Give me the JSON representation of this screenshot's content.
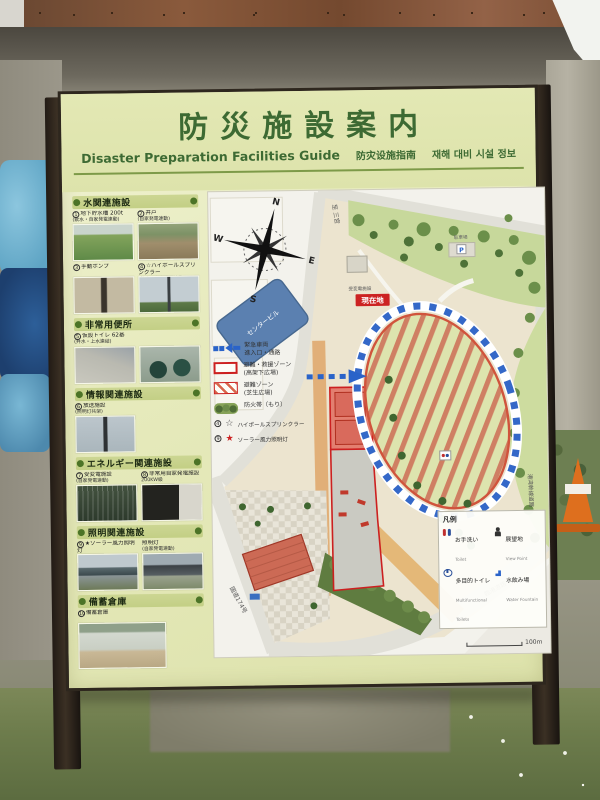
{
  "sign": {
    "title": "防災施設案内",
    "subtitles": {
      "en": "Disaster Preparation Facilities Guide",
      "zh": "防灾设施指南",
      "ko": "재해 대비 시설 정보"
    },
    "sidebar": {
      "sections": [
        {
          "title": "水関連施設",
          "items": [
            {
              "num": "1",
              "label": "地下貯水槽 200t",
              "sub": "(飲水・自家発電連動)"
            },
            {
              "num": "2",
              "label": "井戸",
              "sub": "(自家発電連動)"
            },
            {
              "num": "3",
              "label": "手動ポンプ",
              "sub": ""
            },
            {
              "num": "4",
              "label": "☆ハイポールスプリンクラー",
              "sub": "(飲水・自家発電連動)"
            }
          ]
        },
        {
          "title": "非常用便所",
          "items": [
            {
              "num": "5",
              "label": "仮設トイレ 62基",
              "sub": "(井水・上水連結)"
            }
          ]
        },
        {
          "title": "情報関連施設",
          "items": [
            {
              "num": "6",
              "label": "放送施設",
              "sub": "(照明灯共架)"
            }
          ]
        },
        {
          "title": "エネルギー関連施設",
          "items": [
            {
              "num": "7",
              "label": "受変電施設",
              "sub": "(自家発電連動)"
            },
            {
              "num": "8",
              "label": "非常用自家発電施設",
              "sub": "200KW級"
            }
          ]
        },
        {
          "title": "照明関連施設",
          "items": [
            {
              "num": "9",
              "label": "★ソーラー風力照明灯",
              "sub": ""
            },
            {
              "num": "",
              "label": "照明灯",
              "sub": "(自家発電連動)"
            }
          ]
        },
        {
          "title": "備蓄倉庫",
          "items": [
            {
              "num": "10",
              "label": "備蓄倉庫",
              "sub": ""
            }
          ]
        }
      ]
    },
    "map": {
      "compass": {
        "n": "N",
        "e": "E",
        "s": "S",
        "w": "W"
      },
      "labels": {
        "current_location": "現在地",
        "building": "センタービル",
        "substation": "受変電施設",
        "parking": "駐車場",
        "parking_icon": "P",
        "road_top": "至 三宮",
        "road_left": "国道174号",
        "road_bottom": "臨港道路",
        "road_right": "港湾幹線道路"
      },
      "zone_legend": [
        {
          "icon": "blue-dashed-arrow",
          "line1": "緊急車両",
          "line2": "進入口・通路"
        },
        {
          "icon": "red-outline-box",
          "line1": "避難・救援ゾーン",
          "line2": "(高架下広場)"
        },
        {
          "icon": "red-hatch-box",
          "line1": "避難ゾーン",
          "line2": "(芝生広場)"
        },
        {
          "icon": "firebreak-trees",
          "line1": "防火帯（もり）",
          "line2": ""
        },
        {
          "icon": "white-star",
          "num": "4",
          "glyph": "☆",
          "line1": "ハイポールスプリンクラー",
          "line2": ""
        },
        {
          "icon": "red-star",
          "num": "9",
          "glyph": "★",
          "line1": "ソーラー風力照明灯",
          "line2": ""
        }
      ],
      "facility_legend": {
        "title": "凡例",
        "items": [
          {
            "jp": "お手洗い",
            "en": "Toilet",
            "icon": "toilet-icon"
          },
          {
            "jp": "多目的トイレ",
            "en": "Multifunctional Toilets",
            "icon": "wheelchair-icon"
          },
          {
            "jp": "展望地",
            "en": "View Point",
            "icon": "viewpoint-icon"
          },
          {
            "jp": "水飲み場",
            "en": "Water Fountain",
            "icon": "fountain-icon"
          }
        ],
        "scale_label": "100m"
      }
    }
  },
  "colors": {
    "board_bg": "#e6eabc",
    "title_green": "#3d6a33",
    "section_band": "#c9d48e",
    "zone_red": "#cc2222",
    "route_blue": "#2a63c9",
    "park_green": "#c7d89b",
    "stripe_orange": "#cf7f63"
  }
}
